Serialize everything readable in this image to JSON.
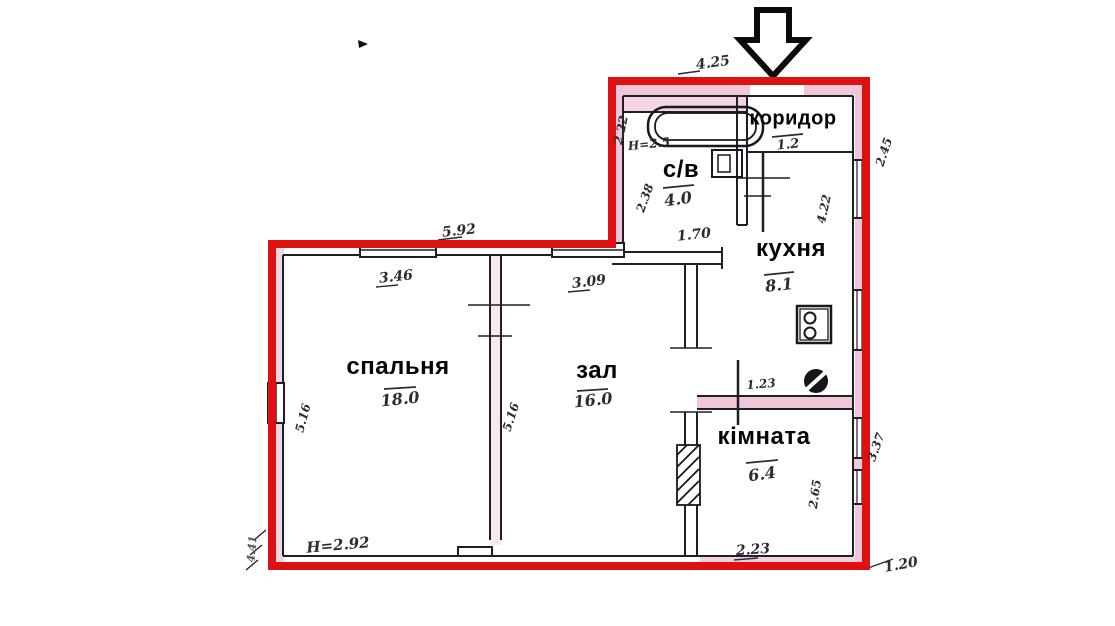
{
  "plan_title": "apartment-floor-plan",
  "colors": {
    "outline": "#dd1111",
    "wall_shade": "#f0c6d8",
    "ink": "#1f1f28",
    "paper": "#ffffff"
  },
  "rooms": [
    {
      "id": "corridor",
      "name": "коридор",
      "area": "1.2"
    },
    {
      "id": "bathroom",
      "name": "с/в",
      "area": "4.0"
    },
    {
      "id": "kitchen",
      "name": "кухня",
      "area": "8.1"
    },
    {
      "id": "bedroom",
      "name": "спальня",
      "area": "18.0"
    },
    {
      "id": "hall",
      "name": "зал",
      "area": "16.0"
    },
    {
      "id": "room",
      "name": "кімната",
      "area": "6.4"
    }
  ],
  "dimensions": {
    "entry_top_width": "4.25",
    "lower_block_top_width": "5.92",
    "bedroom_top_width": "3.46",
    "hall_top_width": "3.09",
    "bathroom_door_width": "1.70",
    "bathroom_height_note": "H=2.5",
    "bathroom_left_upper": "2.22",
    "bathroom_left_lower": "2.38",
    "kitchen_right_depth": "4.22",
    "outside_top_right": "2.45",
    "kitchen_wall_width": "1.23",
    "room_right_depth": "2.65",
    "outside_bottom_right_depth": "3.37",
    "room_bottom_width": "2.23",
    "outside_bottom_right_offset": "1.20",
    "bedroom_left_depth": "5.16",
    "bedroom_right_depth": "5.16",
    "ceiling_height_note": "H=2.92",
    "outside_left_mark": "4.41"
  },
  "icons": {
    "entrance": "down-arrow",
    "bathtub": "bathtub",
    "toilet": "toilet",
    "stove": "stove",
    "sink": "sink",
    "shaft": "hatched-duct"
  }
}
